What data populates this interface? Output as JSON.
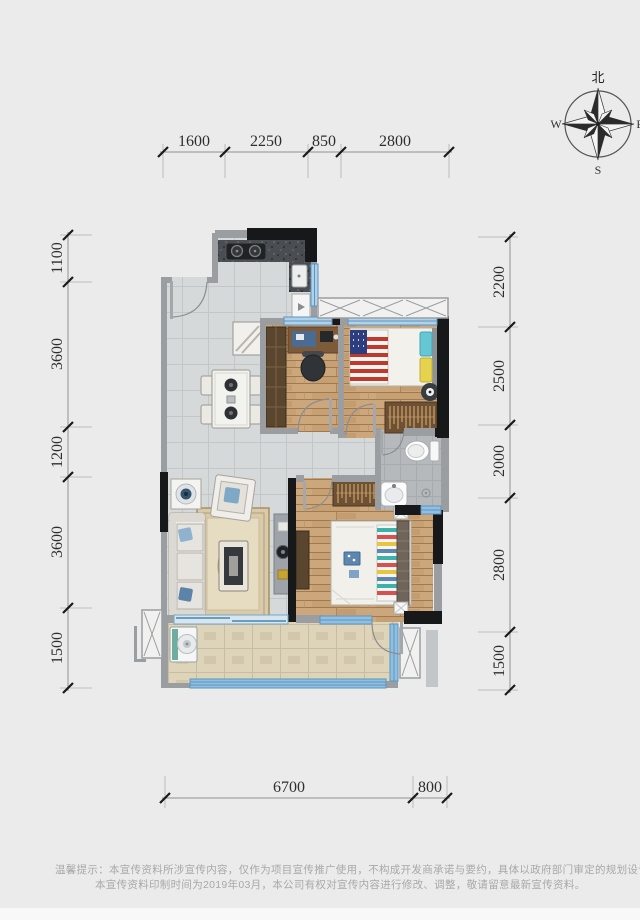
{
  "page": {
    "background": "#ebebeb",
    "footer_band": "#f8f8f8"
  },
  "compass": {
    "north_label": "北",
    "west_label": "W",
    "east_label": "E",
    "south_label": "S"
  },
  "dimensions_mm": {
    "top": [
      "1600",
      "2250",
      "850",
      "2800"
    ],
    "left": [
      "1100",
      "3600",
      "1200",
      "3600",
      "1500"
    ],
    "right": [
      "2200",
      "2500",
      "2000",
      "2800",
      "1500"
    ],
    "bottom": [
      "6700",
      "800"
    ]
  },
  "disclaimer": {
    "line1": "温馨提示：本宣传资料所涉宣传内容，仅作为项目宣传推广使用，不构成开发商承诺与要约，具体以政府部门审定的规划设计文件及商品房买卖合同约定",
    "line2": "本宣传资料印制时间为2019年03月，本公司有权对宣传内容进行修改、调整，敬请留意最新宣传资料。"
  },
  "colors": {
    "wall": "#17181a",
    "wall_secondary": "#9b9ea1",
    "window": "#aed2ea",
    "window_strong": "#8fc0e2",
    "wood_floor": "#c69f73",
    "gray_tile": "#d6d9da",
    "balcony_tile": "#ddd4ba",
    "bath_stone": "#b6b9bb",
    "counter_granite": "#4a4d51",
    "dimension_text": "#2e2e2e",
    "flag_red": "#c0392b",
    "flag_blue": "#2c3e7e"
  }
}
